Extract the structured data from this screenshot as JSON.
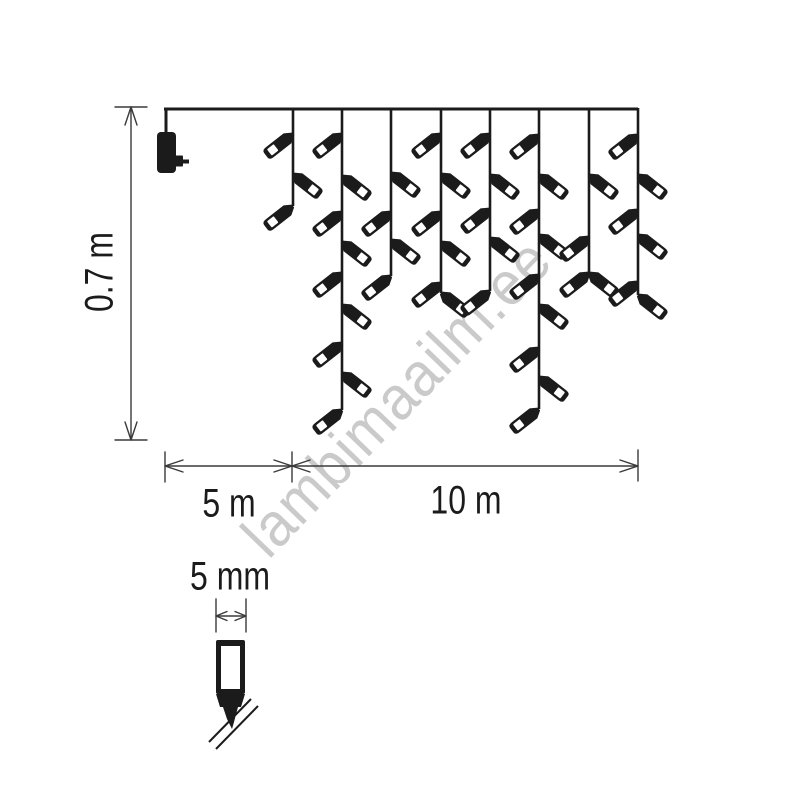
{
  "watermark": {
    "text": "lambimaailm.ee",
    "color": "#cacaca"
  },
  "dimensions": {
    "height": {
      "label": "0.7 m"
    },
    "lead": {
      "label": "5 m"
    },
    "lights": {
      "label": "10 m"
    },
    "bulb": {
      "label": "5 mm"
    }
  },
  "colors": {
    "ink": "#1b1b1b",
    "dimline": "#3a3a3a",
    "background": "#ffffff"
  },
  "curtain": {
    "wire": {
      "x1": 164,
      "x2": 638,
      "y": 109
    },
    "plug": {
      "x": 157,
      "y": 132,
      "width": 19,
      "height": 41
    },
    "drops": [
      {
        "x": 293,
        "end": 206,
        "bulbs": [
          [
            134,
            "L"
          ],
          [
            174,
            "R"
          ],
          [
            206,
            "L"
          ]
        ]
      },
      {
        "x": 342,
        "end": 410,
        "bulbs": [
          [
            134,
            "L"
          ],
          [
            176,
            "R"
          ],
          [
            212,
            "L"
          ],
          [
            242,
            "R"
          ],
          [
            273,
            "L"
          ],
          [
            305,
            "R"
          ],
          [
            343,
            "L"
          ],
          [
            373,
            "R"
          ],
          [
            410,
            "L"
          ]
        ]
      },
      {
        "x": 391,
        "end": 276,
        "bulbs": [
          [
            173,
            "R"
          ],
          [
            212,
            "L"
          ],
          [
            240,
            "R"
          ],
          [
            276,
            "L"
          ]
        ]
      },
      {
        "x": 441,
        "end": 293,
        "bulbs": [
          [
            134,
            "L"
          ],
          [
            174,
            "R"
          ],
          [
            212,
            "L"
          ],
          [
            242,
            "R"
          ],
          [
            283,
            "L"
          ],
          [
            293,
            "R"
          ]
        ]
      },
      {
        "x": 490,
        "end": 291,
        "bulbs": [
          [
            134,
            "L"
          ],
          [
            175,
            "R"
          ],
          [
            209,
            "L"
          ],
          [
            238,
            "R"
          ],
          [
            291,
            "L"
          ]
        ]
      },
      {
        "x": 539,
        "end": 409,
        "bulbs": [
          [
            135,
            "L"
          ],
          [
            175,
            "R"
          ],
          [
            210,
            "L"
          ],
          [
            235,
            "R"
          ],
          [
            275,
            "L"
          ],
          [
            305,
            "R"
          ],
          [
            348,
            "L"
          ],
          [
            377,
            "R"
          ],
          [
            409,
            "L"
          ]
        ]
      },
      {
        "x": 589,
        "end": 273,
        "bulbs": [
          [
            175,
            "R"
          ],
          [
            237,
            "L"
          ],
          [
            273,
            "L"
          ],
          [
            273,
            "R"
          ]
        ]
      },
      {
        "x": 638,
        "end": 295,
        "bulbs": [
          [
            135,
            "L"
          ],
          [
            175,
            "R"
          ],
          [
            210,
            "L"
          ],
          [
            235,
            "R"
          ],
          [
            282,
            "L"
          ],
          [
            295,
            "R"
          ]
        ]
      }
    ]
  }
}
